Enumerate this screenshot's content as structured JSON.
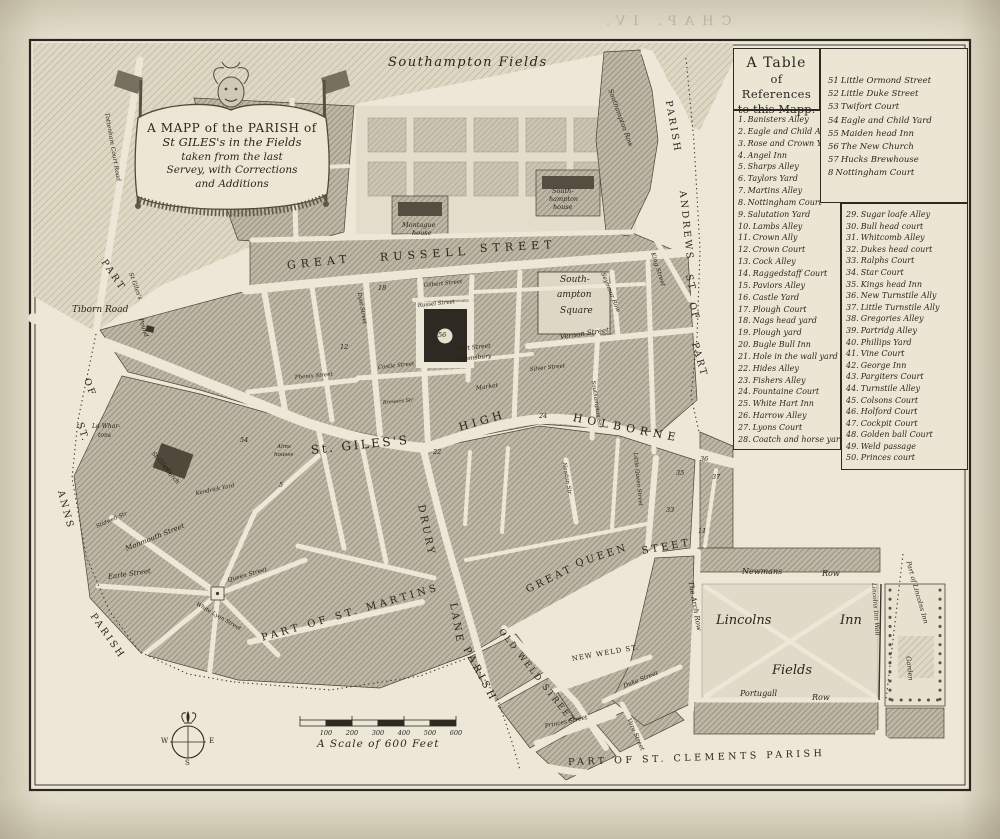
{
  "page": {
    "bleed_text": "CHAP. IV.",
    "shelfmark": "V2.B4.P75"
  },
  "cartouche": {
    "lines": [
      "A MAPP of the PARISH of",
      "St GILES's in the Fields",
      "taken from the last",
      "Servey, with Corrections",
      "and Additions"
    ]
  },
  "table": {
    "title_lines": [
      "A Table",
      "of References",
      "to this Mapp."
    ],
    "top_right": [
      {
        "num": "51",
        "name": "Little Ormond Street"
      },
      {
        "num": "52",
        "name": "Little Duke Street"
      },
      {
        "num": "53",
        "name": "Twifort Court"
      },
      {
        "num": "54",
        "name": "Eagle and Child Yard"
      },
      {
        "num": "55",
        "name": "Maiden head Inn"
      },
      {
        "num": "56",
        "name": "The New Church"
      },
      {
        "num": "57",
        "name": "Hucks Brewhouse"
      },
      {
        "num": "8",
        "name": "Nottingham Court"
      }
    ],
    "left": [
      {
        "num": "1.",
        "name": "Banisters Alley"
      },
      {
        "num": "2.",
        "name": "Eagle and Child Alley"
      },
      {
        "num": "3.",
        "name": "Rose and Crown Yard"
      },
      {
        "num": "4.",
        "name": "Angel Inn"
      },
      {
        "num": "5.",
        "name": "Sharps Alley"
      },
      {
        "num": "6.",
        "name": "Taylors Yard"
      },
      {
        "num": "7.",
        "name": "Martins Alley"
      },
      {
        "num": "8.",
        "name": "Nottingham Court"
      },
      {
        "num": "9.",
        "name": "Salutation Yard"
      },
      {
        "num": "10.",
        "name": "Lambs Alley"
      },
      {
        "num": "11.",
        "name": "Crown Ally"
      },
      {
        "num": "12.",
        "name": "Crown Court"
      },
      {
        "num": "13.",
        "name": "Cock Alley"
      },
      {
        "num": "14.",
        "name": "Raggedstaff Court"
      },
      {
        "num": "15.",
        "name": "Paviors Alley"
      },
      {
        "num": "16.",
        "name": "Castle Yard"
      },
      {
        "num": "17.",
        "name": "Plough Court"
      },
      {
        "num": "18.",
        "name": "Nags head yard"
      },
      {
        "num": "19.",
        "name": "Plough yard"
      },
      {
        "num": "20.",
        "name": "Bugle Bull Inn"
      },
      {
        "num": "21.",
        "name": "Hole in the wall yard"
      },
      {
        "num": "22.",
        "name": "Hides Alley"
      },
      {
        "num": "23.",
        "name": "Fishers Alley"
      },
      {
        "num": "24.",
        "name": "Fountaine Court"
      },
      {
        "num": "25.",
        "name": "White Hart Inn"
      },
      {
        "num": "26.",
        "name": "Harrow Alley"
      },
      {
        "num": "27.",
        "name": "Lyons Court"
      },
      {
        "num": "28.",
        "name": "Coatch and horse yard"
      }
    ],
    "right": [
      {
        "num": "29.",
        "name": "Sugar loafe Alley"
      },
      {
        "num": "30.",
        "name": "Bull head court"
      },
      {
        "num": "31.",
        "name": "Whitcomb Alley"
      },
      {
        "num": "32.",
        "name": "Dukes head court"
      },
      {
        "num": "33.",
        "name": "Ralphs Court"
      },
      {
        "num": "34.",
        "name": "Star Court"
      },
      {
        "num": "35.",
        "name": "Kings head Inn"
      },
      {
        "num": "36.",
        "name": "New Turnstile Ally"
      },
      {
        "num": "37.",
        "name": "Little Turnstile Ally"
      },
      {
        "num": "38.",
        "name": "Gregories Alley"
      },
      {
        "num": "39.",
        "name": "Partridg Alley"
      },
      {
        "num": "40.",
        "name": "Phillips Yard"
      },
      {
        "num": "41.",
        "name": "Vine Court"
      },
      {
        "num": "42.",
        "name": "George Inn"
      },
      {
        "num": "43.",
        "name": "Pargiters Court"
      },
      {
        "num": "44.",
        "name": "Turnstile Alley"
      },
      {
        "num": "45.",
        "name": "Colsons Court"
      },
      {
        "num": "46.",
        "name": "Holford Court"
      },
      {
        "num": "47.",
        "name": "Cockpit Court"
      },
      {
        "num": "48.",
        "name": "Golden ball Court"
      },
      {
        "num": "49.",
        "name": "Weld passage"
      },
      {
        "num": "50.",
        "name": "Princes court"
      }
    ]
  },
  "scale_bar": {
    "ticks": [
      "100",
      "200",
      "300",
      "400",
      "500",
      "600"
    ],
    "caption": "A Scale of 600 Feet"
  },
  "compass": {
    "west": "W",
    "east": "E",
    "south": "S"
  },
  "map_labels": [
    {
      "t": "Southampton Fields",
      "x": 388,
      "y": 56,
      "s": 13,
      "ls": 1.5,
      "i": 1
    },
    {
      "t": "GREAT",
      "x": 287,
      "y": 260,
      "r": -6,
      "s": 11,
      "ls": 5
    },
    {
      "t": "RUSSELL",
      "x": 380,
      "y": 252,
      "r": -4,
      "s": 11,
      "ls": 5
    },
    {
      "t": "STREET",
      "x": 480,
      "y": 243,
      "r": -3,
      "s": 11,
      "ls": 5
    },
    {
      "t": "HIGH",
      "x": 459,
      "y": 422,
      "r": -16,
      "s": 11,
      "ls": 4
    },
    {
      "t": "HOLBORNE",
      "x": 573,
      "y": 412,
      "r": 11,
      "s": 11,
      "ls": 5
    },
    {
      "t": "St. GILES'S",
      "x": 311,
      "y": 444,
      "r": -6,
      "s": 12,
      "ls": 2.5
    },
    {
      "t": "DRURY",
      "x": 420,
      "y": 500,
      "r": 78,
      "s": 10,
      "ls": 3
    },
    {
      "t": "LANE",
      "x": 452,
      "y": 598,
      "r": 80,
      "s": 10,
      "ls": 3
    },
    {
      "t": "GREAT",
      "x": 527,
      "y": 586,
      "r": -26,
      "s": 10,
      "ls": 3
    },
    {
      "t": "QUEEN",
      "x": 576,
      "y": 560,
      "r": -18,
      "s": 10,
      "ls": 3
    },
    {
      "t": "STEET",
      "x": 642,
      "y": 547,
      "r": -10,
      "s": 10,
      "ls": 3
    },
    {
      "t": "PART OF ST. MARTINS",
      "x": 262,
      "y": 634,
      "r": -16,
      "s": 10,
      "ls": 3.5
    },
    {
      "t": "PARISH",
      "x": 465,
      "y": 643,
      "r": 62,
      "s": 10,
      "ls": 3.5
    },
    {
      "t": "PART OF ST. CLEMENTS PARISH",
      "x": 568,
      "y": 758,
      "r": -2,
      "s": 9.5,
      "ls": 3.5
    },
    {
      "t": "PART",
      "x": 103,
      "y": 256,
      "r": 56,
      "s": 9.5,
      "ls": 2.5
    },
    {
      "t": "OF",
      "x": 86,
      "y": 374,
      "r": 70,
      "s": 9.5,
      "ls": 2.5
    },
    {
      "t": "ST.",
      "x": 79,
      "y": 418,
      "r": 72,
      "s": 9.5,
      "ls": 2
    },
    {
      "t": "ANNS",
      "x": 60,
      "y": 486,
      "r": 75,
      "s": 9.5,
      "ls": 2.5
    },
    {
      "t": "PARISH",
      "x": 92,
      "y": 610,
      "r": 55,
      "s": 9.5,
      "ls": 2.5
    },
    {
      "t": "PARISH",
      "x": 668,
      "y": 96,
      "r": 80,
      "s": 9.5,
      "ls": 2.5
    },
    {
      "t": "ANDREWS",
      "x": 682,
      "y": 186,
      "r": 84,
      "s": 9.5,
      "ls": 2.5
    },
    {
      "t": "ST.",
      "x": 688,
      "y": 270,
      "r": 76,
      "s": 9.5,
      "ls": 2
    },
    {
      "t": "OF",
      "x": 691,
      "y": 298,
      "r": 74,
      "s": 9.5,
      "ls": 2
    },
    {
      "t": "PART",
      "x": 694,
      "y": 338,
      "r": 74,
      "s": 9.5,
      "ls": 2.5
    },
    {
      "t": "Montague",
      "x": 402,
      "y": 222,
      "s": 6.5,
      "i": 1
    },
    {
      "t": "house",
      "x": 412,
      "y": 230,
      "s": 6.5,
      "i": 1
    },
    {
      "t": "South-",
      "x": 552,
      "y": 188,
      "s": 6.5,
      "i": 1
    },
    {
      "t": "hampton",
      "x": 549,
      "y": 196,
      "s": 6.5,
      "i": 1
    },
    {
      "t": "house",
      "x": 553,
      "y": 204,
      "s": 6.5,
      "i": 1
    },
    {
      "t": "Southampton Row",
      "x": 610,
      "y": 86,
      "r": 70,
      "s": 6.5,
      "i": 1
    },
    {
      "t": "South-",
      "x": 560,
      "y": 276,
      "s": 9,
      "i": 1
    },
    {
      "t": "ampton",
      "x": 557,
      "y": 291,
      "s": 9,
      "i": 1
    },
    {
      "t": "Square",
      "x": 560,
      "y": 307,
      "s": 9,
      "i": 1
    },
    {
      "t": "Seymour Row",
      "x": 602,
      "y": 270,
      "r": 68,
      "s": 6,
      "i": 1
    },
    {
      "t": "King Street",
      "x": 652,
      "y": 250,
      "r": 72,
      "s": 6,
      "i": 1
    },
    {
      "t": "Vernon Street",
      "x": 560,
      "y": 334,
      "r": -8,
      "s": 7,
      "i": 1
    },
    {
      "t": "Silver Street",
      "x": 530,
      "y": 368,
      "r": -6,
      "s": 5.5,
      "i": 1
    },
    {
      "t": "Southampton Str",
      "x": 592,
      "y": 378,
      "r": 82,
      "s": 5.5,
      "i": 1
    },
    {
      "t": "Gilbert Street",
      "x": 424,
      "y": 284,
      "r": -6,
      "s": 5.5,
      "i": 1
    },
    {
      "t": "Russel Street",
      "x": 418,
      "y": 304,
      "r": -6,
      "s": 5.5,
      "i": 1
    },
    {
      "t": "Dyot Street",
      "x": 358,
      "y": 290,
      "r": 80,
      "s": 5.5,
      "i": 1
    },
    {
      "t": "Hart Street",
      "x": 456,
      "y": 347,
      "r": -6,
      "s": 6,
      "i": 1
    },
    {
      "t": "Blomsbury",
      "x": 459,
      "y": 357,
      "r": -6,
      "s": 6,
      "i": 1
    },
    {
      "t": "Market",
      "x": 476,
      "y": 386,
      "r": -8,
      "s": 6,
      "i": 1
    },
    {
      "t": "Castle Street",
      "x": 378,
      "y": 366,
      "r": -6,
      "s": 5.5,
      "i": 1
    },
    {
      "t": "Phenix Street",
      "x": 295,
      "y": 376,
      "r": -5,
      "s": 5.5,
      "i": 1
    },
    {
      "t": "Brewers Str",
      "x": 383,
      "y": 401,
      "r": -5,
      "s": 5,
      "i": 1
    },
    {
      "t": "Tiborn Road",
      "x": 72,
      "y": 306,
      "s": 9,
      "i": 1
    },
    {
      "t": "Tottenham Court Road",
      "x": 106,
      "y": 110,
      "r": 80,
      "s": 6,
      "i": 1
    },
    {
      "t": "St Giles's",
      "x": 130,
      "y": 270,
      "r": 70,
      "s": 6,
      "i": 1
    },
    {
      "t": "Pound",
      "x": 140,
      "y": 316,
      "r": 72,
      "s": 6,
      "i": 1
    },
    {
      "t": "Ld Whar-",
      "x": 92,
      "y": 424,
      "s": 6,
      "i": 1
    },
    {
      "t": "tons",
      "x": 98,
      "y": 433,
      "s": 6,
      "i": 1
    },
    {
      "t": "St Giles's",
      "x": 152,
      "y": 450,
      "r": 48,
      "s": 6,
      "i": 1
    },
    {
      "t": "Church",
      "x": 163,
      "y": 464,
      "r": 48,
      "s": 6,
      "i": 1
    },
    {
      "t": "Alms",
      "x": 277,
      "y": 445,
      "s": 5.5,
      "i": 1
    },
    {
      "t": "houses",
      "x": 274,
      "y": 453,
      "s": 5.5,
      "i": 1
    },
    {
      "t": "Monmouth Street",
      "x": 126,
      "y": 546,
      "r": -22,
      "s": 7,
      "i": 1
    },
    {
      "t": "Earle Street",
      "x": 108,
      "y": 574,
      "r": -8,
      "s": 7,
      "i": 1
    },
    {
      "t": "Stidwell Str",
      "x": 97,
      "y": 525,
      "r": -24,
      "s": 5.5,
      "i": 1
    },
    {
      "t": "Queen Street",
      "x": 228,
      "y": 578,
      "r": -16,
      "s": 6,
      "i": 1
    },
    {
      "t": "White Lyon Street",
      "x": 196,
      "y": 602,
      "r": 30,
      "s": 5.5,
      "i": 1
    },
    {
      "t": "Kendrick Yard",
      "x": 196,
      "y": 492,
      "r": -12,
      "s": 5.5,
      "i": 1
    },
    {
      "t": "Little Queen Street",
      "x": 634,
      "y": 450,
      "r": 84,
      "s": 5.5,
      "i": 1
    },
    {
      "t": "Newton Str",
      "x": 563,
      "y": 460,
      "r": 80,
      "s": 5.5,
      "i": 1
    },
    {
      "t": "OLD WELD STREET",
      "x": 500,
      "y": 626,
      "r": 52,
      "s": 8.5,
      "ls": 2
    },
    {
      "t": "NEW WELD ST.",
      "x": 572,
      "y": 656,
      "r": -10,
      "s": 7,
      "ls": 1
    },
    {
      "t": "Duke Street",
      "x": 624,
      "y": 684,
      "r": -22,
      "s": 6,
      "i": 1
    },
    {
      "t": "Vere Street",
      "x": 628,
      "y": 716,
      "r": 66,
      "s": 6,
      "i": 1
    },
    {
      "t": "Princes Street",
      "x": 545,
      "y": 724,
      "r": -12,
      "s": 6,
      "i": 1
    },
    {
      "t": "Lincolns",
      "x": 716,
      "y": 614,
      "s": 13,
      "i": 1
    },
    {
      "t": "Inn",
      "x": 840,
      "y": 614,
      "s": 13,
      "i": 1
    },
    {
      "t": "Fields",
      "x": 772,
      "y": 664,
      "s": 13,
      "i": 1
    },
    {
      "t": "Newmans",
      "x": 742,
      "y": 568,
      "s": 8,
      "i": 1
    },
    {
      "t": "Row",
      "x": 822,
      "y": 570,
      "s": 8,
      "i": 1
    },
    {
      "t": "Portugall",
      "x": 740,
      "y": 690,
      "s": 8,
      "i": 1
    },
    {
      "t": "Row",
      "x": 812,
      "y": 694,
      "s": 8,
      "i": 1
    },
    {
      "t": "The Arch Row",
      "x": 690,
      "y": 578,
      "r": 80,
      "s": 7,
      "i": 1
    },
    {
      "t": "Lincolns Inn Wall",
      "x": 873,
      "y": 580,
      "r": 86,
      "s": 6,
      "i": 1
    },
    {
      "t": "Part of Lincolns Inn",
      "x": 908,
      "y": 558,
      "r": 74,
      "s": 6.5,
      "i": 1
    },
    {
      "t": "Garden",
      "x": 908,
      "y": 653,
      "r": 84,
      "s": 6.5,
      "i": 1
    }
  ],
  "map_numbers": [
    {
      "n": "18",
      "x": 378,
      "y": 285
    },
    {
      "n": "56",
      "x": 438,
      "y": 332
    },
    {
      "n": "24",
      "x": 539,
      "y": 413
    },
    {
      "n": "22",
      "x": 433,
      "y": 449
    },
    {
      "n": "12",
      "x": 340,
      "y": 344
    },
    {
      "n": "35",
      "x": 676,
      "y": 470
    },
    {
      "n": "36",
      "x": 700,
      "y": 456
    },
    {
      "n": "37",
      "x": 712,
      "y": 474
    },
    {
      "n": "33",
      "x": 666,
      "y": 507
    },
    {
      "n": "54",
      "x": 240,
      "y": 437
    },
    {
      "n": "5",
      "x": 279,
      "y": 482
    },
    {
      "n": "11",
      "x": 698,
      "y": 528
    }
  ]
}
